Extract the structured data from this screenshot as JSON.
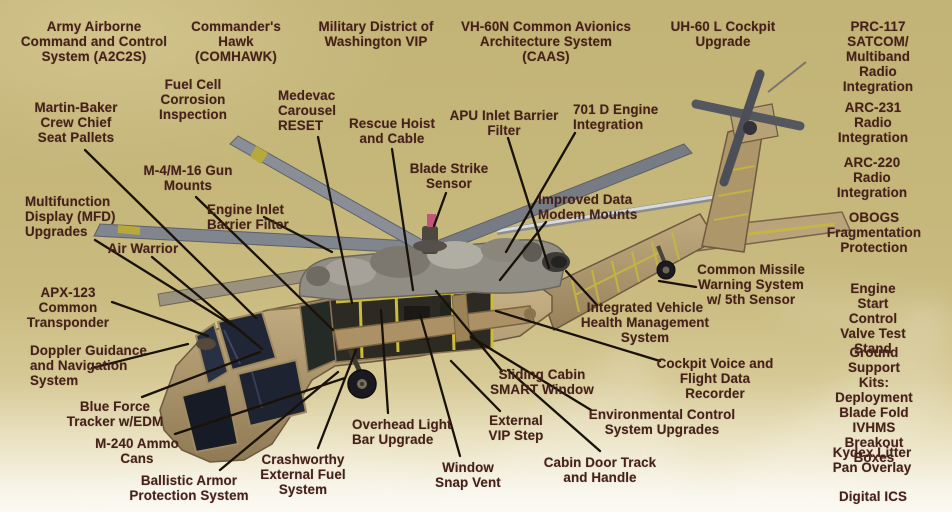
{
  "figure": {
    "description": "Cutaway illustration of a UH-60 Black Hawk style helicopter on a khaki background, surrounded by modernization / upgrade program callout labels connected with black leader lines",
    "colors": {
      "background": "#c6b77b",
      "background_fade": "#fbf9f1",
      "label_text": "#45211a",
      "leader_line": "#191208",
      "fuselage_tan": "#ab9367",
      "rotor_gray": "#82878f",
      "glass_dark": "#1e2432",
      "frame_yellow": "#c9ba3a"
    }
  },
  "labels": [
    {
      "id": "a2c2s",
      "align": "center",
      "x": 94,
      "y": 19,
      "text": "Army Airborne\nCommand and Control\nSystem (A2C2S)"
    },
    {
      "id": "comhawk",
      "align": "center",
      "x": 236,
      "y": 19,
      "text": "Commander's\nHawk\n(COMHAWK)"
    },
    {
      "id": "mdw-vip",
      "align": "center",
      "x": 376,
      "y": 19,
      "text": "Military District of\nWashington VIP"
    },
    {
      "id": "caas",
      "align": "center",
      "x": 546,
      "y": 19,
      "text": "VH-60N Common Avionics\nArchitecture System\n(CAAS)"
    },
    {
      "id": "uh60l-cockpit",
      "align": "center",
      "x": 723,
      "y": 19,
      "text": "UH-60 L Cockpit\nUpgrade"
    },
    {
      "id": "prc117",
      "align": "center",
      "x": 878,
      "y": 19,
      "text": "PRC-117\nSATCOM/\nMultiband Radio\nIntegration"
    },
    {
      "id": "fuel-cell",
      "align": "center",
      "x": 193,
      "y": 77,
      "text": "Fuel Cell\nCorrosion\nInspection"
    },
    {
      "id": "martin-baker",
      "align": "center",
      "x": 76,
      "y": 100,
      "text": "Martin-Baker\nCrew Chief\nSeat Pallets"
    },
    {
      "id": "medevac",
      "align": "left",
      "x": 278,
      "y": 88,
      "text": "Medevac\nCarousel\nRESET"
    },
    {
      "id": "rescue-hoist",
      "align": "center",
      "x": 392,
      "y": 116,
      "text": "Rescue Hoist\nand Cable"
    },
    {
      "id": "apu-filter",
      "align": "center",
      "x": 504,
      "y": 108,
      "text": "APU Inlet Barrier\nFilter"
    },
    {
      "id": "701d-engine",
      "align": "left",
      "x": 573,
      "y": 102,
      "text": "701 D Engine\nIntegration"
    },
    {
      "id": "blade-strike",
      "align": "center",
      "x": 449,
      "y": 161,
      "text": "Blade Strike\nSensor"
    },
    {
      "id": "m4-m16",
      "align": "center",
      "x": 188,
      "y": 163,
      "text": "M-4/M-16 Gun\nMounts"
    },
    {
      "id": "arc231",
      "align": "center",
      "x": 873,
      "y": 100,
      "text": "ARC-231 Radio\nIntegration"
    },
    {
      "id": "arc220",
      "align": "center",
      "x": 872,
      "y": 155,
      "text": "ARC-220 Radio\nIntegration"
    },
    {
      "id": "mfd",
      "align": "left",
      "x": 25,
      "y": 194,
      "text": "Multifunction\nDisplay (MFD)\nUpgrades"
    },
    {
      "id": "engine-inlet",
      "align": "left",
      "x": 207,
      "y": 202,
      "text": "Engine Inlet\nBarrier Filter"
    },
    {
      "id": "air-warrior",
      "align": "center",
      "x": 143,
      "y": 241,
      "text": "Air Warrior"
    },
    {
      "id": "improved-data",
      "align": "left",
      "x": 538,
      "y": 192,
      "text": "Improved Data\nModem Mounts"
    },
    {
      "id": "obogs",
      "align": "center",
      "x": 874,
      "y": 210,
      "text": "OBOGS\nFragmentation\nProtection"
    },
    {
      "id": "apx123",
      "align": "center",
      "x": 68,
      "y": 285,
      "text": "APX-123\nCommon\nTransponder"
    },
    {
      "id": "cmws",
      "align": "center",
      "x": 751,
      "y": 262,
      "text": "Common Missile\nWarning System\nw/ 5th Sensor"
    },
    {
      "id": "engine-start",
      "align": "center",
      "x": 873,
      "y": 281,
      "text": "Engine Start\nControl Valve Test\nStand"
    },
    {
      "id": "ivhms-system",
      "align": "center",
      "x": 645,
      "y": 300,
      "text": "Integrated Vehicle\nHealth Management\nSystem"
    },
    {
      "id": "doppler",
      "align": "left",
      "x": 30,
      "y": 343,
      "text": "Doppler Guidance\nand Navigation\nSystem"
    },
    {
      "id": "blue-force",
      "align": "center",
      "x": 115,
      "y": 399,
      "text": "Blue Force\nTracker w/EDM"
    },
    {
      "id": "sliding-cabin",
      "align": "center",
      "x": 542,
      "y": 367,
      "text": "Sliding Cabin\nSMART Window"
    },
    {
      "id": "cvfdr",
      "align": "center",
      "x": 715,
      "y": 356,
      "text": "Cockpit Voice and\nFlight Data\nRecorder"
    },
    {
      "id": "ground-support",
      "align": "center",
      "x": 874,
      "y": 345,
      "text": "Ground Support Kits:\nDeployment\nBlade Fold\nIVHMS\nBreakout Boxes"
    },
    {
      "id": "env-control",
      "align": "center",
      "x": 662,
      "y": 407,
      "text": "Environmental Control\nSystem Upgrades"
    },
    {
      "id": "m240",
      "align": "center",
      "x": 137,
      "y": 436,
      "text": "M-240 Ammo\nCans"
    },
    {
      "id": "vip-step",
      "align": "center",
      "x": 516,
      "y": 413,
      "text": "External\nVIP Step"
    },
    {
      "id": "overhead-light",
      "align": "left",
      "x": 352,
      "y": 417,
      "text": "Overhead Light\nBar Upgrade"
    },
    {
      "id": "kydex",
      "align": "center",
      "x": 872,
      "y": 445,
      "text": "Kydex Litter\nPan Overlay"
    },
    {
      "id": "ballistic",
      "align": "center",
      "x": 189,
      "y": 473,
      "text": "Ballistic Armor\nProtection System"
    },
    {
      "id": "crashworthy",
      "align": "center",
      "x": 303,
      "y": 452,
      "text": "Crashworthy\nExternal Fuel\nSystem"
    },
    {
      "id": "window-snap",
      "align": "center",
      "x": 468,
      "y": 460,
      "text": "Window\nSnap Vent"
    },
    {
      "id": "cabin-door",
      "align": "center",
      "x": 600,
      "y": 455,
      "text": "Cabin Door Track\nand Handle"
    },
    {
      "id": "digital-ics",
      "align": "center",
      "x": 873,
      "y": 489,
      "text": "Digital ICS"
    }
  ],
  "lines": [
    {
      "for": "martin-baker",
      "x1": 85,
      "y1": 150,
      "x2": 256,
      "y2": 318
    },
    {
      "for": "m4-m16",
      "x1": 196,
      "y1": 197,
      "x2": 333,
      "y2": 330
    },
    {
      "for": "mfd",
      "x1": 95,
      "y1": 240,
      "x2": 240,
      "y2": 330
    },
    {
      "for": "air-warrior",
      "x1": 152,
      "y1": 257,
      "x2": 262,
      "y2": 349
    },
    {
      "for": "engine-inlet",
      "x1": 264,
      "y1": 217,
      "x2": 332,
      "y2": 252
    },
    {
      "for": "apx123",
      "x1": 112,
      "y1": 302,
      "x2": 208,
      "y2": 336
    },
    {
      "for": "doppler",
      "x1": 92,
      "y1": 368,
      "x2": 188,
      "y2": 344
    },
    {
      "for": "blue-force",
      "x1": 142,
      "y1": 397,
      "x2": 260,
      "y2": 352
    },
    {
      "for": "m240",
      "x1": 175,
      "y1": 434,
      "x2": 345,
      "y2": 378
    },
    {
      "for": "ballistic",
      "x1": 220,
      "y1": 470,
      "x2": 338,
      "y2": 372
    },
    {
      "for": "crashworthy",
      "x1": 318,
      "y1": 448,
      "x2": 356,
      "y2": 350
    },
    {
      "for": "medevac",
      "x1": 318,
      "y1": 137,
      "x2": 352,
      "y2": 303
    },
    {
      "for": "rescue-hoist",
      "x1": 392,
      "y1": 149,
      "x2": 413,
      "y2": 290
    },
    {
      "for": "blade-strike",
      "x1": 446,
      "y1": 193,
      "x2": 434,
      "y2": 226
    },
    {
      "for": "apu-filter",
      "x1": 508,
      "y1": 138,
      "x2": 549,
      "y2": 268
    },
    {
      "for": "701d-engine",
      "x1": 575,
      "y1": 133,
      "x2": 506,
      "y2": 252
    },
    {
      "for": "improved-data",
      "x1": 546,
      "y1": 222,
      "x2": 500,
      "y2": 280
    },
    {
      "for": "overhead-light",
      "x1": 388,
      "y1": 413,
      "x2": 381,
      "y2": 310
    },
    {
      "for": "window-snap",
      "x1": 460,
      "y1": 456,
      "x2": 420,
      "y2": 314
    },
    {
      "for": "vip-step",
      "x1": 500,
      "y1": 411,
      "x2": 451,
      "y2": 361
    },
    {
      "for": "cabin-door",
      "x1": 600,
      "y1": 451,
      "x2": 508,
      "y2": 370
    },
    {
      "for": "sliding-cabin",
      "x1": 502,
      "y1": 371,
      "x2": 436,
      "y2": 291
    },
    {
      "for": "cmws",
      "x1": 696,
      "y1": 287,
      "x2": 659,
      "y2": 281
    },
    {
      "for": "ivhms-system",
      "x1": 597,
      "y1": 305,
      "x2": 566,
      "y2": 271
    },
    {
      "for": "cvfdr",
      "x1": 660,
      "y1": 361,
      "x2": 496,
      "y2": 311
    },
    {
      "for": "env-control",
      "x1": 591,
      "y1": 410,
      "x2": 471,
      "y2": 337
    }
  ]
}
